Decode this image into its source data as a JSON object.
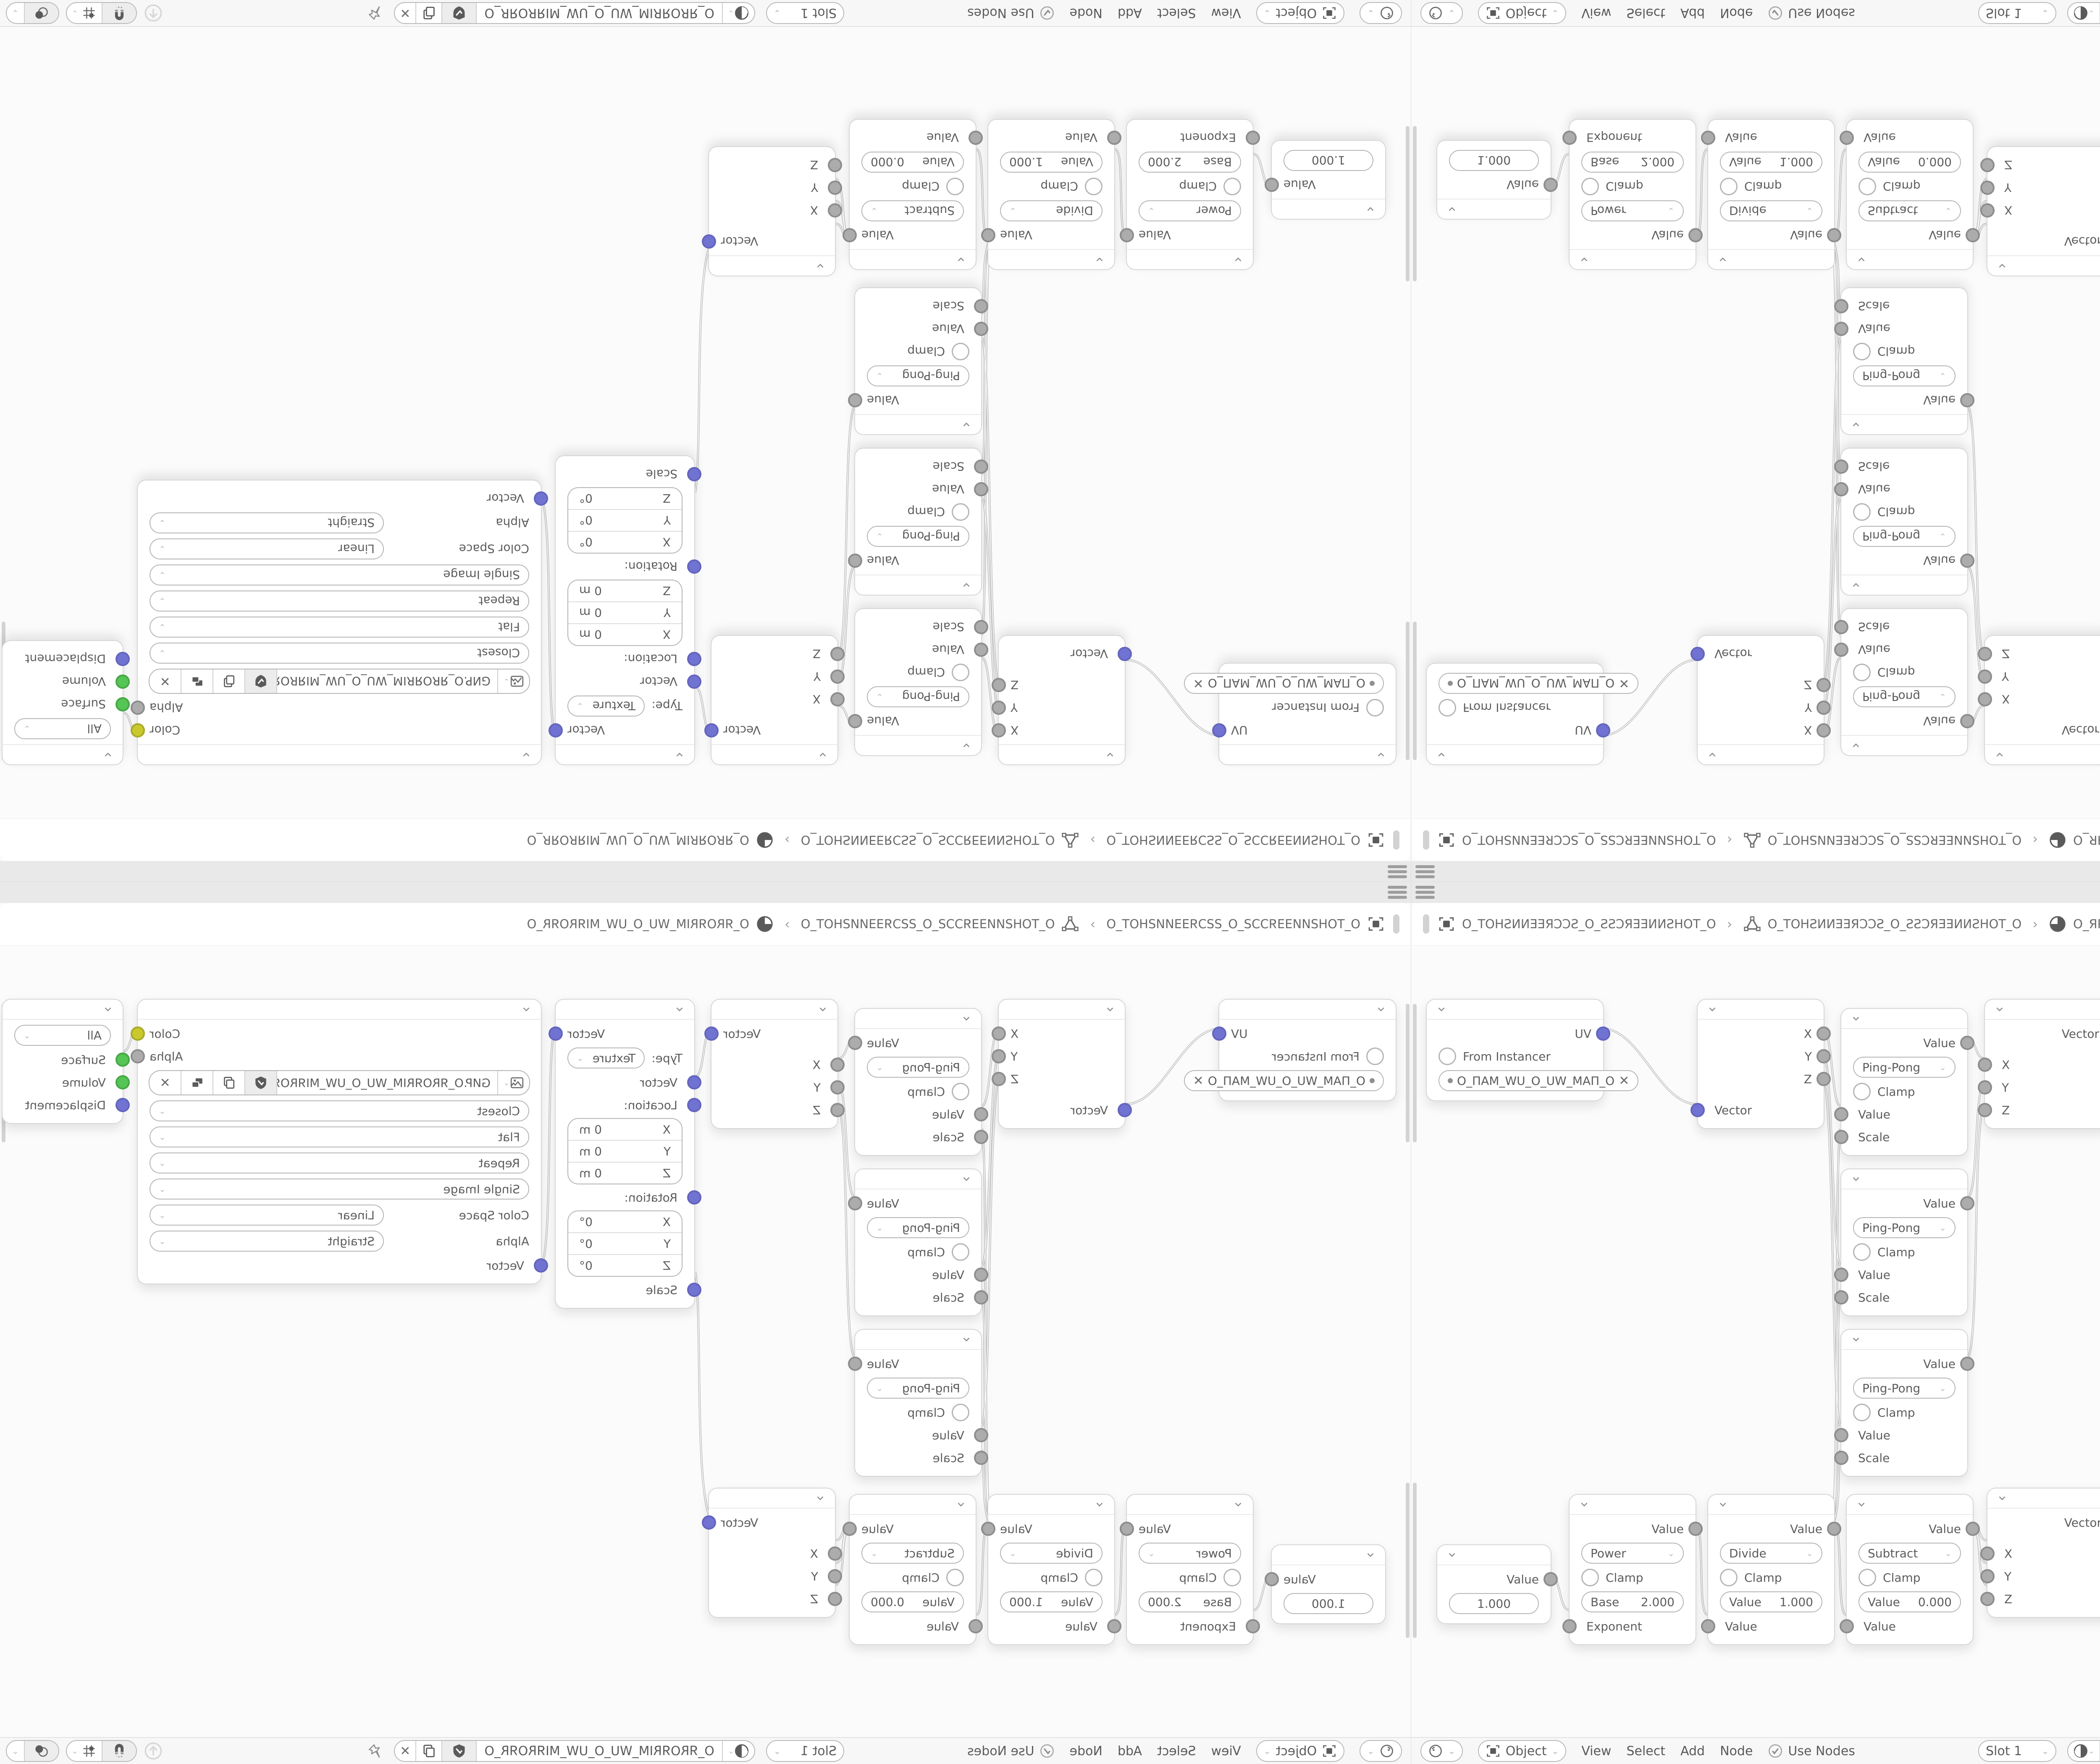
{
  "quadrant": {
    "header": {
      "separator": "›",
      "breadcrumb": [
        {
          "icon": "object-frame-icon",
          "label": "O_TOHƧИИƎƎЯƆƆƧ_O_ƧƧƆЯƎƎИИƧHOT_O"
        },
        {
          "icon": "mesh-triangle-icon",
          "label": "O_TOHƧИИƎƎЯƆƆƧ_O_ƧƧƆЯƎƎИИƧHOT_O"
        },
        {
          "icon": "material-sphere-icon",
          "label": "O_ЯROЯRIM_WU_O_UW_MIЯROЯR_O"
        }
      ]
    },
    "toolbar": {
      "shading_context": "Object",
      "menus": [
        "View",
        "Select",
        "Add",
        "Node"
      ],
      "use_nodes_label": "Use Nodes",
      "slot_label": "Slot 1",
      "material_name": "O_ЯROЯRIM_WU_O_UW_MIЯROЯR_O",
      "close_label": "✕"
    },
    "labels": {
      "x": "X",
      "y": "Y",
      "z": "Z",
      "value": "Value",
      "vector": "Vector",
      "scale": "Scale",
      "clamp": "Clamp",
      "uv": "UV",
      "color": "Color",
      "alpha": "Alpha"
    },
    "nodes": {
      "uvmap": {
        "out": "UV",
        "from_instancer": "From Instancer",
        "uv_name": "O_ПAM_WU_O_UW_MAП_O",
        "clear": "✕"
      },
      "pingpong": {
        "out": "Value",
        "op": "Ping-Pong",
        "clamp": "Clamp",
        "in1": "Value",
        "in2": "Scale"
      },
      "mapping": {
        "out": "Vector",
        "type_label": "Type:",
        "type": "Texture",
        "in": "Vector",
        "location_label": "Location:",
        "rotation_label": "Rotation:",
        "scale_label": "Scale",
        "location": [
          {
            "axis": "X",
            "value": "0 m"
          },
          {
            "axis": "Y",
            "value": "0 m"
          },
          {
            "axis": "Z",
            "value": "0 m"
          }
        ],
        "rotation": [
          {
            "axis": "X",
            "value": "0°"
          },
          {
            "axis": "Y",
            "value": "0°"
          },
          {
            "axis": "Z",
            "value": "0°"
          }
        ]
      },
      "image_texture": {
        "out_color": "Color",
        "out_alpha": "Alpha",
        "filename": "GИP.O_ЯROЯRIM_WU_O_UW_MIЯROЯR_O.PNG",
        "interpolation": "Closest",
        "projection": "Flat",
        "extension": "Repeat",
        "source": "Single Image",
        "color_space_label": "Color Space",
        "color_space": "Linear",
        "alpha_label": "Alpha",
        "alpha_mode": "Straight",
        "in": "Vector",
        "close": "✕"
      },
      "output": {
        "target": "All",
        "in_surface": "Surface",
        "in_volume": "Volume",
        "in_displacement": "Displacement"
      },
      "value": {
        "out": "Value",
        "value": "1.000"
      },
      "math_power": {
        "out": "Value",
        "op": "Power",
        "clamp": "Clamp",
        "field_label": "Base",
        "field_value": "2.000",
        "in": "Exponent"
      },
      "math_divide": {
        "out": "Value",
        "op": "Divide",
        "clamp": "Clamp",
        "field_label": "Value",
        "field_value": "1.000",
        "in": "Value"
      },
      "math_subtract": {
        "out": "Value",
        "op": "Subtract",
        "clamp": "Clamp",
        "field_label": "Value",
        "field_value": "0.000",
        "in": "Value"
      }
    },
    "colors": {
      "socket_vector": "#7173d2",
      "socket_value": "#acacac",
      "socket_color": "#c9c92f",
      "socket_shader": "#55c555",
      "wire": "#bdbdbd",
      "canvas": "#fbfbfb"
    }
  }
}
